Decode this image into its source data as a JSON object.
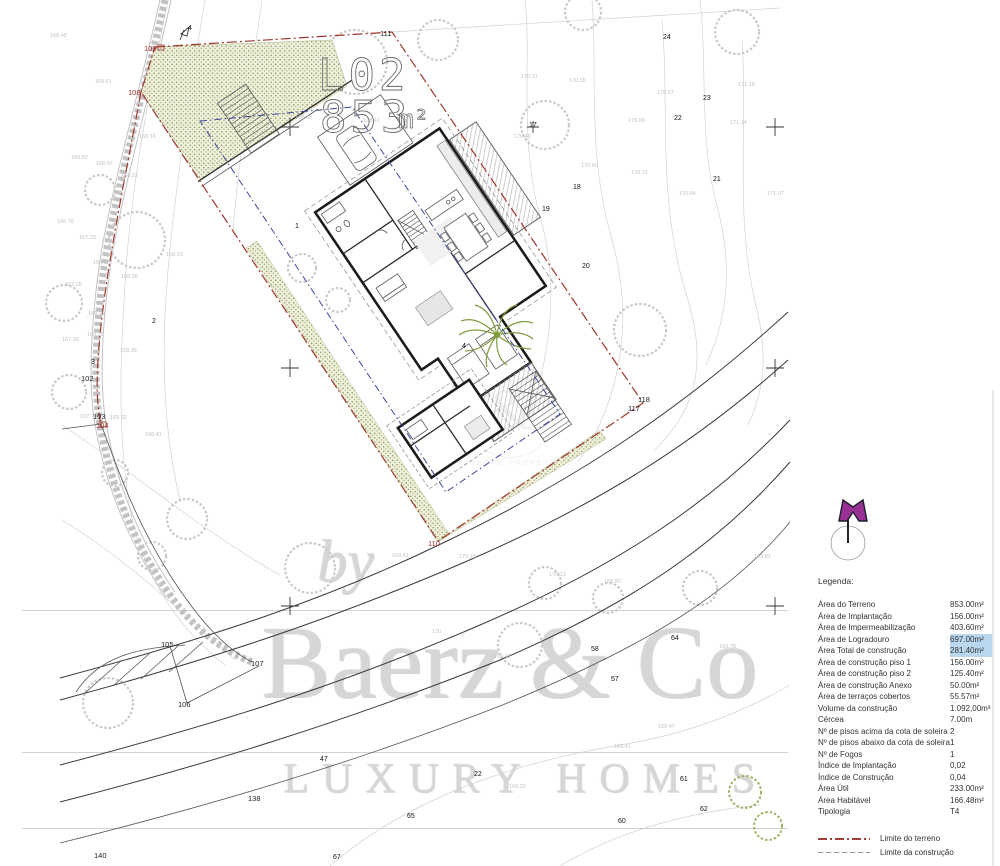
{
  "plan": {
    "parcel_label": "L02",
    "parcel_area_value": "853",
    "parcel_area_unit": "m²",
    "colors": {
      "terrain_boundary": "#9e372e",
      "construction_limit": "#3b4896",
      "hatch_dots": "#8f9b55",
      "contour": "#d2d2d5",
      "highlight": "#b9d8ef",
      "north_marker": "#993093"
    },
    "corner_labels": [
      {
        "t": "108",
        "x": 128,
        "y": 95,
        "c": "red"
      },
      {
        "t": "109",
        "x": 144,
        "y": 51,
        "c": "red"
      },
      {
        "t": "110",
        "x": 428,
        "y": 546,
        "c": "red"
      },
      {
        "t": "111",
        "x": 380,
        "y": 36
      },
      {
        "t": "117",
        "x": 628,
        "y": 411
      },
      {
        "t": "118",
        "x": 638,
        "y": 402
      },
      {
        "t": "105",
        "x": 161,
        "y": 647
      },
      {
        "t": "106",
        "x": 178,
        "y": 707
      },
      {
        "t": "107",
        "x": 251,
        "y": 666
      },
      {
        "t": "138",
        "x": 248,
        "y": 801
      },
      {
        "t": "140",
        "x": 94,
        "y": 858
      },
      {
        "t": "102",
        "x": 81,
        "y": 381
      },
      {
        "t": "103",
        "x": 93,
        "y": 419
      },
      {
        "t": "104",
        "x": 96,
        "y": 428,
        "c": "red"
      }
    ],
    "point_labels": [
      {
        "t": "1",
        "x": 295,
        "y": 228
      },
      {
        "t": "2",
        "x": 152,
        "y": 323
      },
      {
        "t": "3",
        "x": 91,
        "y": 364
      },
      {
        "t": "4",
        "x": 188,
        "y": 30
      },
      {
        "t": "4",
        "x": 462,
        "y": 348
      },
      {
        "t": "17",
        "x": 529,
        "y": 127
      },
      {
        "t": "18",
        "x": 573,
        "y": 189
      },
      {
        "t": "19",
        "x": 542,
        "y": 211
      },
      {
        "t": "20",
        "x": 582,
        "y": 268
      },
      {
        "t": "21",
        "x": 713,
        "y": 181
      },
      {
        "t": "22",
        "x": 674,
        "y": 120
      },
      {
        "t": "23",
        "x": 703,
        "y": 100
      },
      {
        "t": "24",
        "x": 663,
        "y": 39
      },
      {
        "t": "22",
        "x": 474,
        "y": 776
      },
      {
        "t": "47",
        "x": 320,
        "y": 761
      },
      {
        "t": "57",
        "x": 611,
        "y": 681
      },
      {
        "t": "58",
        "x": 591,
        "y": 651
      },
      {
        "t": "64",
        "x": 671,
        "y": 640
      },
      {
        "t": "60",
        "x": 618,
        "y": 823
      },
      {
        "t": "61",
        "x": 680,
        "y": 781
      },
      {
        "t": "62",
        "x": 700,
        "y": 811
      },
      {
        "t": "65",
        "x": 407,
        "y": 818
      },
      {
        "t": "67",
        "x": 333,
        "y": 859
      }
    ],
    "contour_labels": [
      {
        "t": "168.45",
        "x": 50,
        "y": 37
      },
      {
        "t": "168.61",
        "x": 95,
        "y": 83
      },
      {
        "t": "168.16",
        "x": 139,
        "y": 138
      },
      {
        "t": "168.62",
        "x": 71,
        "y": 159
      },
      {
        "t": "168.97",
        "x": 96,
        "y": 165
      },
      {
        "t": "168.23",
        "x": 121,
        "y": 177
      },
      {
        "t": "168.23",
        "x": 166,
        "y": 256
      },
      {
        "t": "166.76",
        "x": 57,
        "y": 223
      },
      {
        "t": "167.23",
        "x": 79,
        "y": 239
      },
      {
        "t": "168.18",
        "x": 93,
        "y": 264
      },
      {
        "t": "168.26",
        "x": 121,
        "y": 278
      },
      {
        "t": "167.25",
        "x": 65,
        "y": 286
      },
      {
        "t": "168.19",
        "x": 88,
        "y": 315
      },
      {
        "t": "168.25",
        "x": 87,
        "y": 336
      },
      {
        "t": "167.26",
        "x": 62,
        "y": 341
      },
      {
        "t": "168.36",
        "x": 120,
        "y": 352
      },
      {
        "t": "167.70",
        "x": 80,
        "y": 418
      },
      {
        "t": "168.32",
        "x": 110,
        "y": 419
      },
      {
        "t": "168.41",
        "x": 145,
        "y": 436
      },
      {
        "t": "168.43",
        "x": 295,
        "y": 119
      },
      {
        "t": "168.41",
        "x": 363,
        "y": 122
      },
      {
        "t": "170.31",
        "x": 521,
        "y": 78
      },
      {
        "t": "170.55",
        "x": 569,
        "y": 82
      },
      {
        "t": "170.67",
        "x": 657,
        "y": 94
      },
      {
        "t": "170.66",
        "x": 628,
        "y": 122
      },
      {
        "t": "171.14",
        "x": 730,
        "y": 124
      },
      {
        "t": "171.18",
        "x": 738,
        "y": 86
      },
      {
        "t": "170.46",
        "x": 514,
        "y": 138
      },
      {
        "t": "170.60",
        "x": 581,
        "y": 167
      },
      {
        "t": "170.72",
        "x": 631,
        "y": 174
      },
      {
        "t": "170.84",
        "x": 679,
        "y": 195
      },
      {
        "t": "171.07",
        "x": 767,
        "y": 195
      },
      {
        "t": "169.61",
        "x": 392,
        "y": 557
      },
      {
        "t": "170.16",
        "x": 459,
        "y": 558
      },
      {
        "t": "170.13",
        "x": 549,
        "y": 576
      },
      {
        "t": "169.80",
        "x": 604,
        "y": 583
      },
      {
        "t": "169.42",
        "x": 494,
        "y": 658
      },
      {
        "t": "169.29",
        "x": 509,
        "y": 788
      },
      {
        "t": "169.41",
        "x": 614,
        "y": 748
      },
      {
        "t": "169.47",
        "x": 658,
        "y": 728
      },
      {
        "t": "169.78",
        "x": 719,
        "y": 648
      },
      {
        "t": "169.83",
        "x": 754,
        "y": 558
      },
      {
        "t": "170",
        "x": 432,
        "y": 633
      }
    ]
  },
  "watermark": {
    "by": "by",
    "name": "Baerz & Co",
    "tagline": "LUXURY HOMES"
  },
  "stamp": {
    "amp": "&",
    "text": "BESPOKE PROPERTY"
  },
  "legend": {
    "title": "Legenda:",
    "rows": [
      {
        "label": "Área do Terreno",
        "value": "853.00m²",
        "highlight": false
      },
      {
        "label": "Área de Implantação",
        "value": "156.00m²",
        "highlight": false
      },
      {
        "label": "Área de Impermeabilização",
        "value": "403.60m²",
        "highlight": false
      },
      {
        "label": "Área de Logradouro",
        "value": "697.00m²",
        "highlight": true
      },
      {
        "label": "Área Total de construção",
        "value": "281.40m²",
        "highlight": true
      },
      {
        "label": "Área de construção piso 1",
        "value": "156.00m²",
        "highlight": false
      },
      {
        "label": "Área de construção piso 2",
        "value": "125.40m²",
        "highlight": false
      },
      {
        "label": "Área de construção Anexo",
        "value": "50.00m²",
        "highlight": false
      },
      {
        "label": "Área de terraços cobertos",
        "value": "55.57m²",
        "highlight": false
      },
      {
        "label": "Volume da construção",
        "value": "1.092,00m³",
        "highlight": false
      },
      {
        "label": "Cércea",
        "value": "7.00m",
        "highlight": false
      },
      {
        "label": "Nº de pisos acima da cota de soleira",
        "value": "2",
        "highlight": false
      },
      {
        "label": "Nº de pisos abaixo da cota de soleira",
        "value": "1",
        "highlight": false
      },
      {
        "label": "Nº de Fogos",
        "value": "1",
        "highlight": false
      },
      {
        "label": "Índice de Implantação",
        "value": "0,02",
        "highlight": false
      },
      {
        "label": "Índice de Construção",
        "value": "0,04",
        "highlight": false
      },
      {
        "label": "Área Útil",
        "value": "233.00m²",
        "highlight": false
      },
      {
        "label": "Área Habitável",
        "value": "166.48m²",
        "highlight": false
      },
      {
        "label": "Tipologia",
        "value": "T4",
        "highlight": false
      }
    ],
    "lines": [
      {
        "label": "Limite do terreno"
      },
      {
        "label": "Limite da construção"
      }
    ]
  }
}
